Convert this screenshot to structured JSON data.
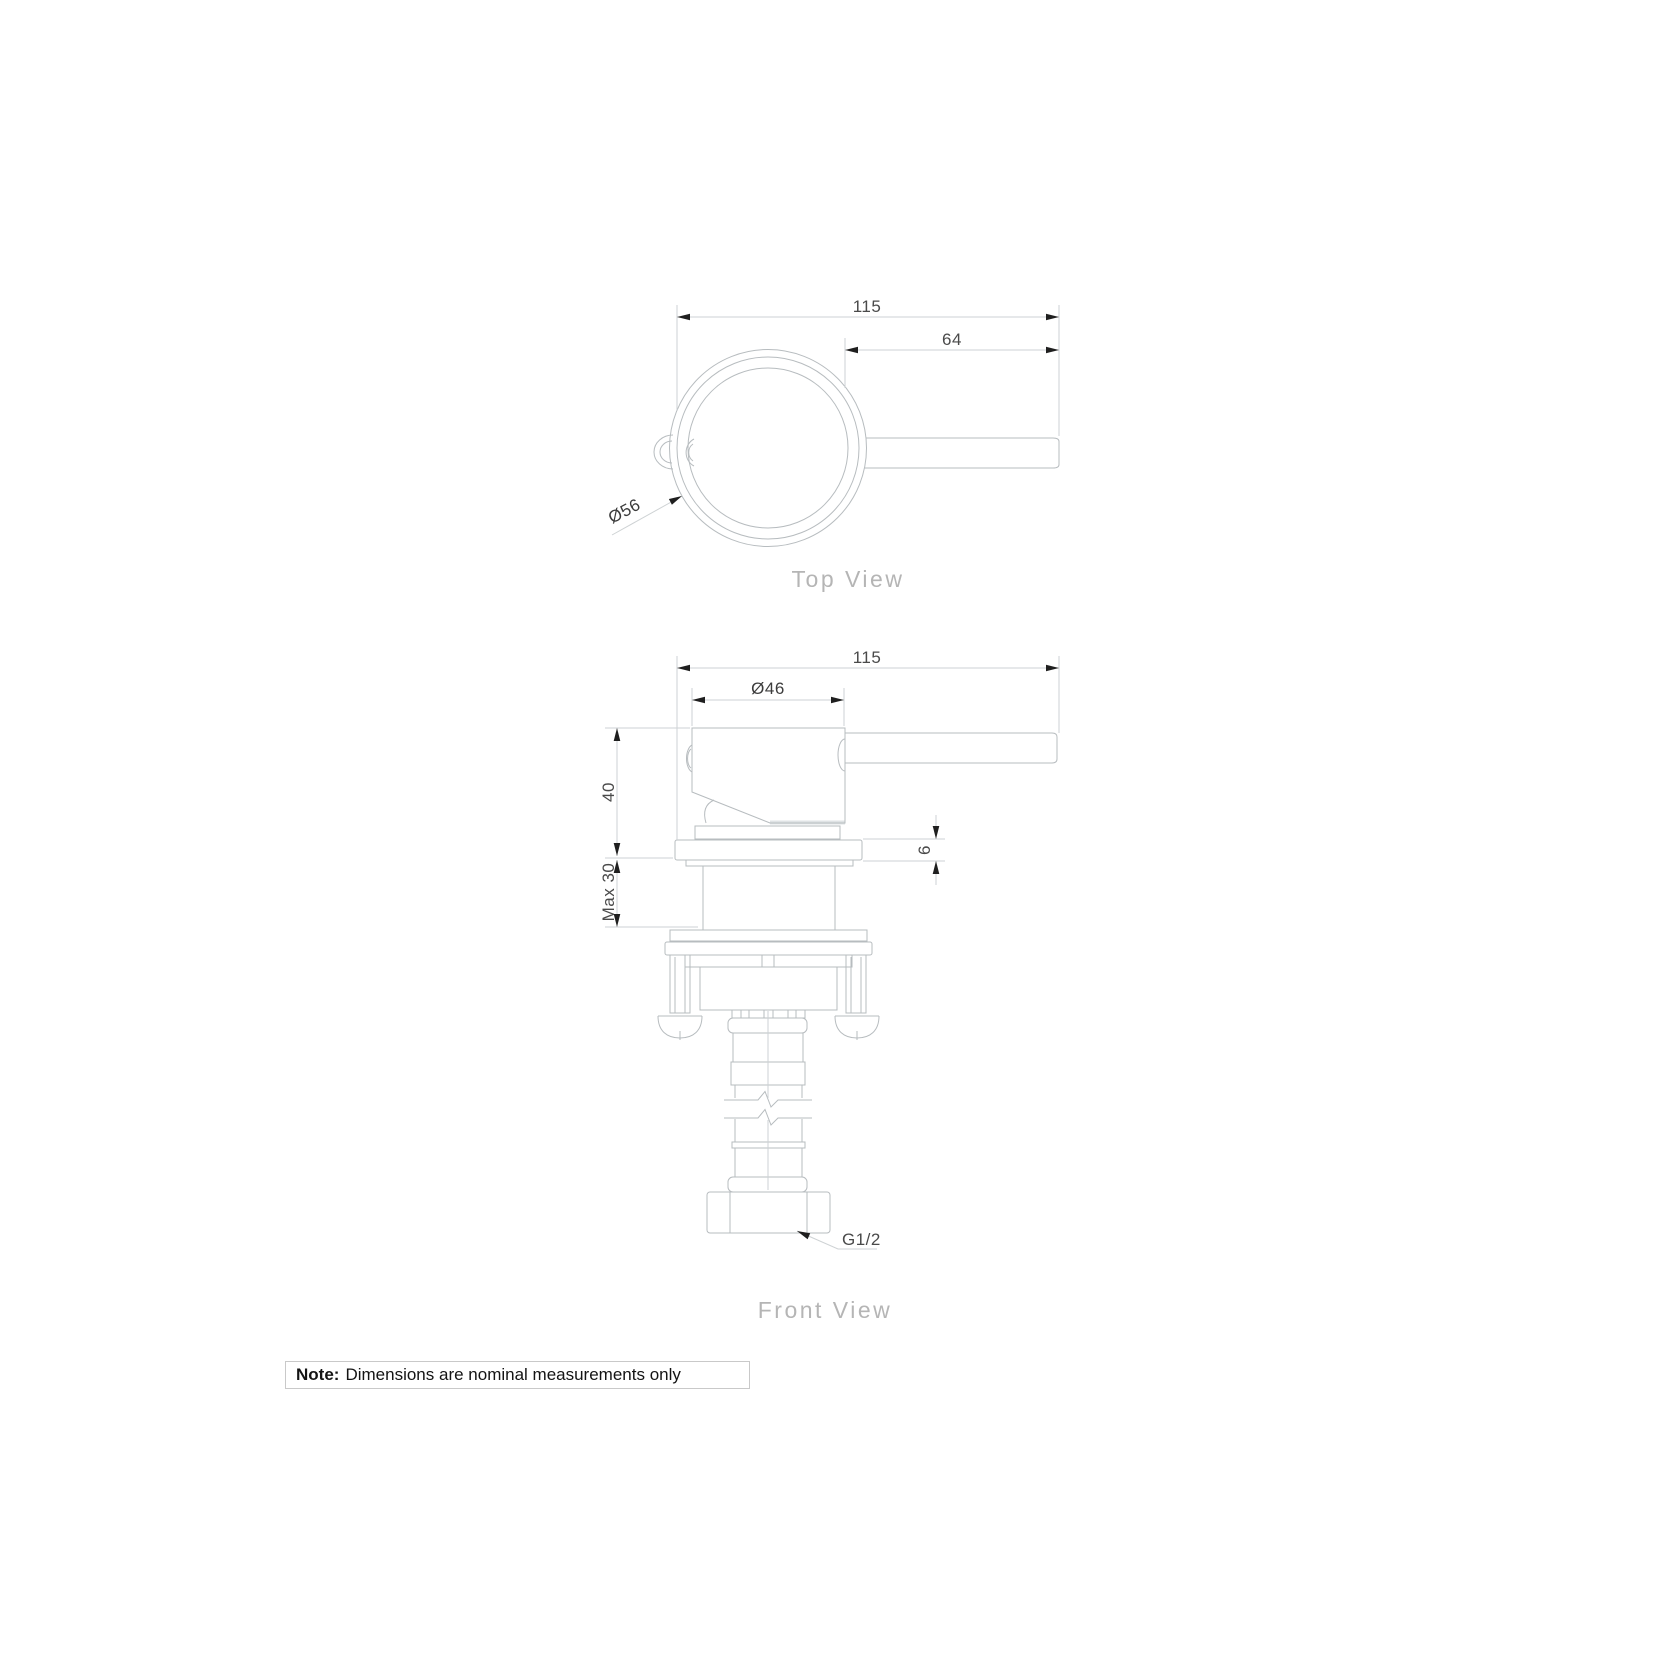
{
  "top_view": {
    "label": "Top View",
    "dim_overall_width": "115",
    "dim_handle_length": "64",
    "dim_trim_diameter": "Ø56"
  },
  "front_view": {
    "label": "Front View",
    "dim_overall_width": "115",
    "dim_body_diameter": "Ø46",
    "dim_body_height": "40",
    "dim_max_wall_depth": "Max 30",
    "dim_plate_thickness": "6",
    "dim_thread": "G1/2"
  },
  "note": {
    "label": "Note:",
    "text": "Dimensions are nominal measurements only"
  },
  "colors": {
    "background": "#ffffff",
    "object_line": "#b7bcbf",
    "dimension_line": "#ced2d4",
    "arrowhead": "#1f1f1f",
    "dimension_text": "#4a4a4a",
    "view_label_text": "#b5b5b5",
    "note_text": "#141414",
    "note_border": "#c9c9c9",
    "hatch_fill": "#dfe3e5"
  }
}
